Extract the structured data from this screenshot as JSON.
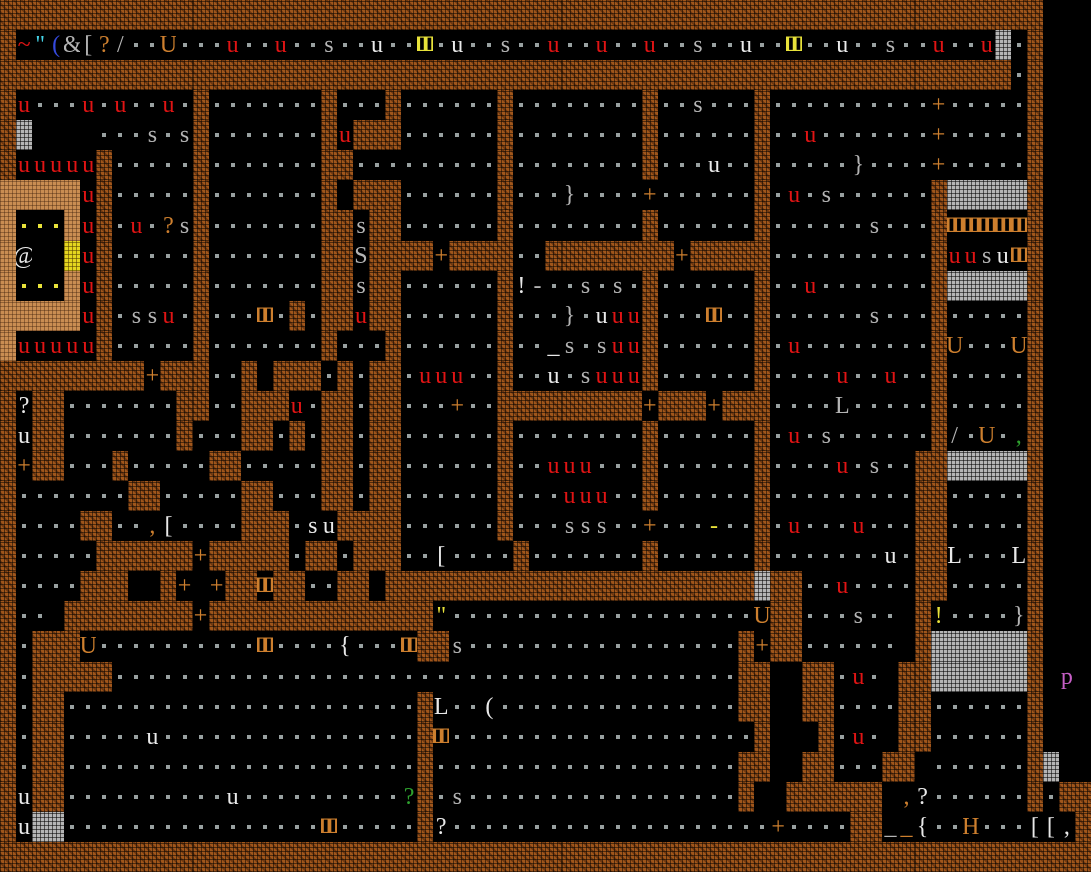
{
  "app": {
    "name": "Dwarf Fortress",
    "view": "fortress-map-ascii",
    "description": "Top-down ASCII fortress map: rooms carved in brown rock walls, floor dots, creatures and items"
  },
  "grid": {
    "cols": 68,
    "rows": 29,
    "tile_width_px": 16,
    "tile_height_px": 30
  },
  "legend": {
    "wall": {
      "char": "#",
      "color": "#a0561b",
      "name": "rough rock wall"
    },
    "tan_wall": {
      "char": "%",
      "color": "#c98d52",
      "name": "tan clay wall"
    },
    "smoothed_wall": {
      "char": "1",
      "color": "#b5b5b5",
      "name": "gray smoothed block"
    },
    "gold_block": {
      "char": "2",
      "color": "#e4d51f",
      "name": "yellow speckled block"
    },
    "floor": {
      "char": ".",
      "color": "#98a0a0",
      "name": "floor with dot"
    },
    "bars_glyph": {
      "char": "3",
      "display": "Ⅲ",
      "name": "vertical-bars glyph"
    },
    "glyph_colors": {
      "r": "#e01414",
      "w": "#e9e9e9",
      "g": "#b4b4b4",
      "o": "#cd7f2e",
      "y": "#e8e23a",
      "n": "#2ea12e",
      "c": "#45d4e8",
      "b": "#3549dd",
      "m": "#c75fc7",
      "d": "#98a0a0"
    },
    "notable_glyphs": [
      "@ player",
      "u fowl creature",
      "s/S cat creatures",
      "+ door",
      "U/[ ] { } ( L H items",
      "p purple creature",
      "? item",
      "yellow dots: items in shrine room"
    ]
  },
  "map": {
    "rows": [
      "#################################################################   ",
      "#~\"(&[?/..U...u..u..s..u..3.u..s..u..u..u..s..u..3..u..s..u..u1.#   ",
      "###############################################################.#   ",
      "#u...u.u..u.#.......#...#.....    .#........#..s...#..........+.....#   ",
      "#1    ...s.s#.......#u###......#........#......#..u.......+.....#   ",
      "#uuuuu#.....#.......##.........#........#...u..#.....}....+.....#   ",
      "%%%%%u#.....#.......# ###......#...}....+......#.u.s......#11111#   ",
      "%...%u#.u.?s#.......##s##......#........#......#......s...#33333#   ",
      "%@  2u#.....#.......##S####+####..######@##+#####..........#uusu3#   ",
      "%...%u#.....#.......##s##......#!-..s.s.#......#..u.......#11111#   ",
      "%%%%%u#.ssu.#...3.#.##u##......#...}.uuu#...3..#....s...#......#   ",
      "%uuuuu#.....#.......#...#......#.._s.suu#......#.u........#U...U#   ",
      "#########+###..# ###.#.##.uuu..#..u.suuu#......#....u..u..#.....#   ",
      "#?##.......##..###u.##.##...+..##########+###+###....L.....#.....#   ",
      "#u##.......#...##.#.##.##......#........#......#.u.s......#/.U.,#   ",
      "#+##...#......##.....##.##.....#..uuu...#......#...u.s..##111111#   ",
      "#.......##.....##...##.##......#...uuu..#......#........##......#   ",
      "#....##..,[....###.su####......#...sss..+...-..#.u...u...##.....#   ",
      "#.....######+#####.##.###..[....#.......#......#.....u.##L...L#   ",
      "#....###  #+ +##3##..## ################1##..u....##......#   ",
      "#.. #########+##############\"...................U##...s.. #!....}#   ",
      "#.###U.....3....{...3##s.............#+##...... #111111#   ",
      "#.#####.............................##  ##.u. ##1111# p ",
      "#.##..................#L..(.........##  ##....##......#   ",
      "#.##.....u............#3..............#   #.u. ##......#   ",
      "#.##..................#...............##  ##...## ......#1  ",
      "#u##......u.....?#.s.............#  ######## ,?......#.##",
      "#u11................3.....#?..............+....##__{..H...[[,#",
      "####################################################################"
    ],
    "rows_fixed": [
      "#################################################################   ",
      "#~\"(&[?/..U...u..u..s..u..3.u..s..u..u..u..s..u..3..u..s..u..u1.#   ",
      "###############################################################.#   ",
      "#u...u.u..u.#.......#...#......#........#..s...#..........+.....#   ",
      "#1    ...s.s#.......#u###......#........#......#..u.......+.....#   ",
      "#uuuuu#.....#.......##.........#........#...u..#.....}....+.....#   ",
      "%%%%%u#.....#.......# ###......#...}....+......#.u.s......#11111#   ",
      "%...%u#.u.?s#.......##s##......#........#......#....s...#33333#   ",
      "%@  2u#.....#.......##S####+####..########+#####........#uusu3#   ",
      "%...%u#.....#.......##s##......#!-..s.s.#......#u.......#11111#   ",
      "%%%%%u#.ssu.#...3.#.##u##......#...}.uuu#...3..#....s...#.....#   ",
      "%uuuuu#.....#.......#...#......#.._s.suu#......#.u......#U...U#   ",
      "#########+###..# ###.#.##.uuu..#..u.suuu#......#..u..u..#.....#   ",
      "#?##.......##..###u.##.##...+..##########+###+###..L.....#.....#   ",
      "#u##.......#...##.#.##.##......#........#......#.u.s......#/.U.,#   ",
      "#+##...#......##.....##.##.....#..uuu...#......#..u.s..##111111#   ",
      "#.......##.....##...##.##......#...uuu..#......#.......##.....#   ",
      "#....##..,[....###.su####......#...sss..+...-..#.u...u...##....#   ",
      "#.....######+#####.###.###..[....#.......#......#....u.##L...L#   ",
      "#....###  #+ +##3##..## ###############1##..u....##.....#   ",
      "#.. ########+###############\"..................U##...s.. #!...}#   ",
      "#.###U.....3....{...3##s..................#+##...... #111111#   ",
      "#.#####..........................##  ##.u. ##1111# p ",
      "#.##..................#L..(.........##  ##....##......#   ",
      "#.##.....u............#3..............#   #.u. ##......#   ",
      "#.##..................#..............##  ##...## ....#1  ",
      "#u##......u.....?#.s..............#  ##### ,?......#.##",
      "#u11..............3.....#?..............+....##__{..H...[[,#",
      "####################################################################"
    ],
    "color_overrides": {
      "1": {
        "1": "r",
        "2": "c",
        "3": "b",
        "6": "o",
        "10": "o",
        "14": "r",
        "17": "r",
        "23": "w",
        "26": "y",
        "28": "w",
        "34": "r",
        "37": "r",
        "40": "r",
        "46": "w",
        "49": "y",
        "52": "w",
        "58": "r",
        "61": "r"
      },
      "3": {
        "1": "r",
        "5": "r",
        "7": "r",
        "10": "r",
        "58": "o"
      },
      "4": {
        "21": "r",
        "50": "r",
        "58": "o"
      },
      "5": {
        "1": "r",
        "2": "r",
        "3": "r",
        "4": "r",
        "5": "r",
        "44": "w",
        "58": "o"
      },
      "6": {
        "5": "r",
        "40": "o",
        "49": "r"
      },
      "7": {
        "1": "y",
        "2": "y",
        "3": "y",
        "5": "r",
        "8": "r",
        "10": "o",
        "59": "o",
        "60": "o",
        "61": "o",
        "62": "o",
        "63": "o"
      },
      "8": {
        "1": "w",
        "5": "r",
        "27": "o",
        "42": "o",
        "59": "r",
        "60": "r",
        "62": "w",
        "63": "o"
      },
      "9": {
        "1": "y",
        "2": "y",
        "3": "y",
        "5": "r",
        "32": "w",
        "50": "r"
      },
      "10": {
        "5": "r",
        "10": "r",
        "16": "o",
        "22": "r",
        "37": "w",
        "38": "r",
        "39": "r",
        "44": "o"
      },
      "11": {
        "1": "r",
        "2": "r",
        "3": "r",
        "4": "r",
        "5": "r",
        "34": "w",
        "38": "r",
        "39": "r",
        "49": "r",
        "59": "o",
        "63": "o"
      },
      "12": {
        "9": "o",
        "26": "r",
        "27": "r",
        "28": "r",
        "34": "w",
        "37": "r",
        "38": "r",
        "39": "r",
        "52": "r",
        "55": "r"
      },
      "13": {
        "1": "w",
        "18": "r",
        "28": "o",
        "40": "o",
        "44": "o"
      },
      "14": {
        "1": "w",
        "49": "r",
        "61": "o",
        "63": "n"
      },
      "15": {
        "1": "o",
        "34": "r",
        "35": "r",
        "36": "r",
        "52": "r"
      },
      "16": {
        "35": "r",
        "36": "r",
        "37": "r"
      },
      "17": {
        "9": "o",
        "10": "w",
        "19": "w",
        "20": "w",
        "40": "o",
        "44": "y",
        "49": "r",
        "53": "r"
      },
      "18": {
        "12": "o",
        "27": "w",
        "55": "w",
        "59": "w",
        "63": "w"
      },
      "19": {
        "11": "o",
        "13": "o",
        "16": "o",
        "52": "r"
      },
      "20": {
        "12": "o",
        "27": "y",
        "47": "o",
        "58": "y"
      },
      "21": {
        "5": "o",
        "16": "o",
        "21": "w",
        "25": "o",
        "47": "o"
      },
      "22": {
        "53": "r",
        "66": "m"
      },
      "23": {
        "27": "w",
        "30": "w"
      },
      "24": {
        "9": "w",
        "27": "o",
        "53": "r"
      },
      "26": {
        "1": "w",
        "14": "w",
        "25": "n",
        "56": "o",
        "57": "w"
      },
      "27": {
        "1": "w",
        "20": "o",
        "27": "w",
        "48": "o",
        "56": "o",
        "57": "w",
        "60": "o",
        "64": "w",
        "65": "w",
        "66": "w"
      }
    },
    "canonical_rows": [
      [
        "#################################################################",
        "   "
      ],
      [
        "#~\"(&[?/..",
        "U...u..u..",
        "s..u..3.u.",
        ".s..u..u..",
        "u..s..u..3",
        "..u..s..u.",
        ".u1.#   "
      ],
      [
        "###############################################################",
        ".#",
        "   "
      ],
      [
        "#u...u.u..",
        "u.#.......",
        "#...#.....",
        ".#........",
        "#..s...#..",
        "........+.",
        "....#   "
      ],
      [
        "#1    ...s",
        ".s#.......",
        "#u###.....",
        ".#........",
        "#......#..",
        "u.......+.",
        "....#   "
      ],
      [
        "#uuuuu#...",
        "..#.......",
        "##........",
        ".#........",
        "#...u..#..",
        "...}....+.",
        "....#   "
      ],
      [
        "%%%%%u#...",
        "..#.......",
        "# ###.....",
        ".#...}....",
        "+......#.u",
        ".s......#1",
        "1111#   "
      ],
      [
        "%...%u#.u.",
        "?s#.......",
        "##s##.....",
        ".#........",
        "#......#..",
        "....s...#3",
        "3333#   "
      ],
      [
        "%@  2u#...",
        "..#.......",
        "##S####+##",
        "##..######",
        "##+#####..",
        "........#u",
        "usu3#   "
      ],
      [
        "%...%u#...",
        "..#.......",
        "##s##.....",
        ".#!-..s.s.",
        "#......#..",
        "u.......#1",
        "1111#   "
      ],
      [
        "%%%%%u#.ss",
        "u.#...3.#.",
        "##u##.....",
        ".#...}.uuu",
        "#...3..#..",
        "....s...#.",
        "....#   "
      ],
      [
        "%uuuuu#...",
        "..#.......",
        "#...#.....",
        ".#.._s.suu",
        "#......#.u",
        "........#U",
        "...U#   "
      ],
      [
        "#########+",
        "###..# ###",
        ".#.##.uuu.",
        ".#..u.suuu",
        "#......#..",
        "..u..u..#.",
        "....#   "
      ],
      [
        "#?##......",
        ".##..###u.",
        "##.##...+.",
        ".#########",
        "+###+###..",
        "..L.....#.",
        "....#   "
      ],
      [
        "#u##......",
        ".#...##.#.",
        "##.##.....",
        ".#........",
        "#......#.u",
        ".s......#/",
        ".U.,#   "
      ],
      [
        "#+##...#..",
        "...##.....",
        "##.##.....",
        ".#..uuu...",
        "#......#..",
        "..u.s..##1",
        "1111#   "
      ],
      [
        "#.......##",
        ".....##...",
        "##.##.....",
        ".#...uuu..",
        "#......#..",
        ".......##.",
        "....#   "
      ],
      [
        "#....##..,",
        "[....###.s",
        "u####.....",
        ".#...sss..",
        "+...-..#.u",
        "...u...##.",
        "....#   "
      ],
      [
        "#.....####",
        "##+#####.#",
        "#.###..[..",
        "..#.......",
        "#......#..",
        ".....u.##L",
        "...L#   "
      ],
      [
        "#....###  ",
        "#+ +##3##.",
        ".## #####",
        "#",
        "##########",
        "#######1##",
        "..u....##.",
        "....#   "
      ],
      [
        "#.. ######",
        "##+#######",
        "#######\"..",
        "..........",
        ".......U##",
        "...s.. #!.",
        "...}#   "
      ],
      [
        "#.###U....",
        "......3...",
        ".{...3##s.",
        "..........",
        "......#+##",
        "...... #11",
        "1111#   "
      ],
      [
        "#.#####...",
        "..........",
        "..........",
        "..........",
        "......##  ",
        "##.u. ##11",
        "1111# p "
      ],
      [
        "#.##......",
        "..........",
        "......#L..",
        "(.........",
        "......##  ",
        "##....##..",
        "....#   "
      ],
      [
        "#.##.....u",
        "..........",
        "......#3..",
        "..........",
        ".......#  ",
        " #.u. ##..",
        "....#   "
      ],
      [
        "#.##......",
        "..........",
        "......#...",
        "..........",
        "......##  ",
        "##...## ..",
        "....#1  "
      ],
      [
        "#u##......",
        "....u.....",
        ".....?#.s.",
        "..........",
        "......#  #",
        "##### ,?..",
        "....#.##"
      ],
      [
        "#u11......",
        "..........",
        "3.....#?..",
        "..........",
        "........+.",
        "...##__{..",
        "H...[[,#"
      ],
      [
        "####################################################################"
      ]
    ]
  }
}
